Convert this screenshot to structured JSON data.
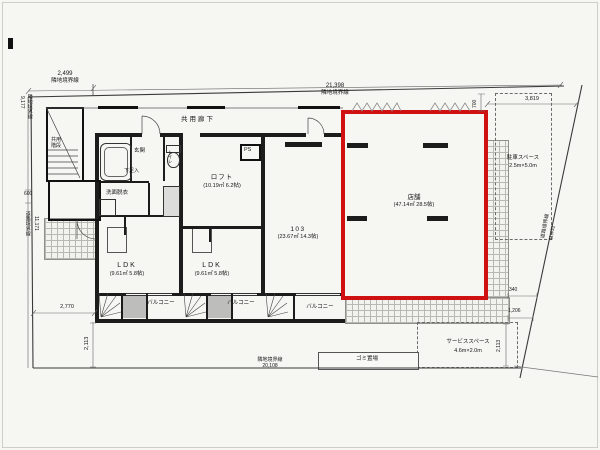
{
  "plan": {
    "type": "floor-plan",
    "accent_color": "#d01111",
    "boundaries": {
      "top_left": {
        "length": "2,499",
        "label": "隣地境界線"
      },
      "top": {
        "length": "21,398",
        "label": "隣地境界線"
      },
      "left_upper": {
        "length": "9,177",
        "label": "隣地境界線"
      },
      "left_lower": {
        "length": "11,171",
        "label": "道路境界線"
      },
      "bottom": {
        "length": "20,108",
        "label": "隣地境界線"
      },
      "right": {
        "length": "11,431",
        "label": "道路境界線"
      }
    },
    "dimensions": {
      "d600": "600",
      "d700": "700",
      "d2770": "2,770",
      "d2113_left": "2,113",
      "d3819": "3,819",
      "d340": "340",
      "d1206": "1,206",
      "d2113_right": "2,113"
    },
    "rooms": {
      "corridor": "共用廊下",
      "common_stairs": "共用階段",
      "entrance": "玄関",
      "shoe_box": "下足入",
      "toilet": "トイレ",
      "washroom": "洗面脱衣",
      "loft": {
        "name": "ロフト",
        "area": "(10.19㎡ 6.2帖)"
      },
      "ldk1": {
        "name": "LDK",
        "area": "(9.61㎡ 5.8帖)"
      },
      "ldk2": {
        "name": "LDK",
        "area": "(9.61㎡ 5.8帖)"
      },
      "unit103": {
        "name": "103",
        "area": "(23.67㎡ 14.3帖)"
      },
      "shop": {
        "name": "店舗",
        "area": "(47.14㎡ 28.5帖)"
      },
      "balcony1": "バルコニー",
      "balcony2": "バルコニー",
      "balcony3": "バルコニー",
      "ps": "PS",
      "parking": {
        "name": "駐車スペース",
        "size": "2.5m×5.0m"
      },
      "service": {
        "name": "サービススペース",
        "size": "4.6m×2.0m"
      },
      "garbage": "ゴミ置場"
    }
  }
}
